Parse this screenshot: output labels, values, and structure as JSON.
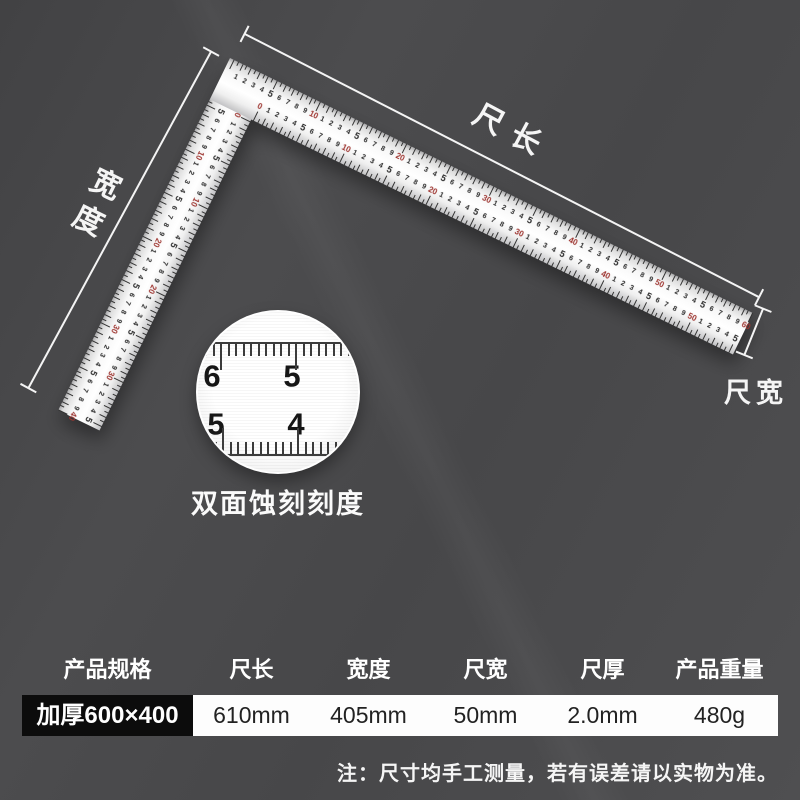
{
  "annotations": {
    "length_label": "尺长",
    "width_label": "宽度",
    "blade_width_label": "尺宽"
  },
  "ruler": {
    "outer_long_max": 60,
    "inner_long_max": 55,
    "outer_short_max": 40,
    "inner_short_max": 35,
    "tick_color": "#333333",
    "unit_color": "#2b2b2b",
    "tens_color": "#9e3530"
  },
  "magnifier": {
    "caption": "双面蚀刻刻度",
    "top_numbers": [
      "6",
      "5"
    ],
    "bottom_numbers": [
      "5",
      "4"
    ]
  },
  "spec_table": {
    "header_bg": "#f05c0e",
    "headers": [
      "产品规格",
      "尺长",
      "宽度",
      "尺宽",
      "尺厚",
      "产品重量"
    ],
    "row": [
      "加厚600×400",
      "610mm",
      "405mm",
      "50mm",
      "2.0mm",
      "480g"
    ]
  },
  "note": "注：尺寸均手工测量，若有误差请以实物为准。"
}
